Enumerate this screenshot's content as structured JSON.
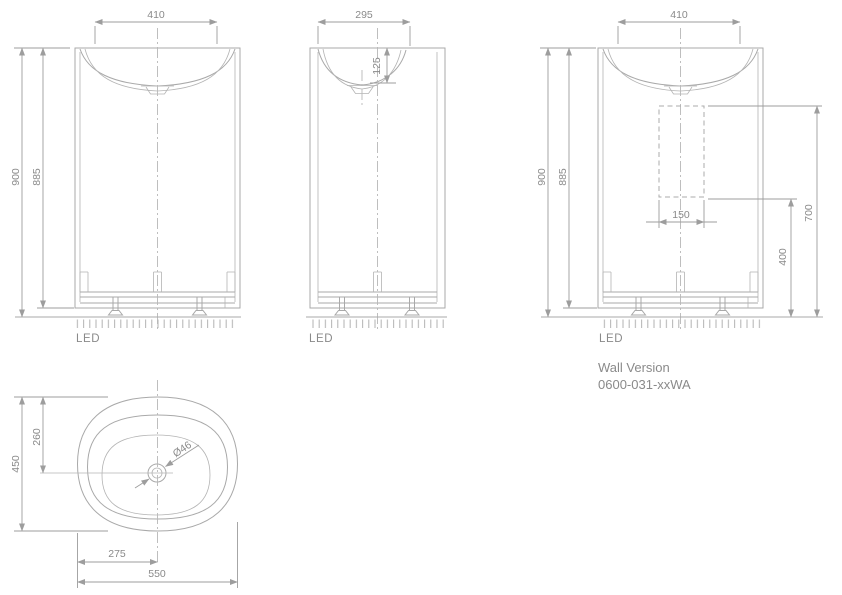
{
  "palette": {
    "line": "#a9a9a9",
    "dim_line": "#9d9d9d",
    "text": "#8a8a8a",
    "background": "#ffffff"
  },
  "front_view": {
    "width_top": "410",
    "height_overall": "900",
    "height_body": "885",
    "ground_label": "LED"
  },
  "side_view": {
    "width_top": "295",
    "bowl_depth": "125",
    "ground_label": "LED"
  },
  "wall_view": {
    "width_top": "410",
    "height_overall": "900",
    "height_body": "885",
    "cutout_width": "150",
    "cutout_bottom_height": "400",
    "cutout_top_height": "700",
    "ground_label": "LED",
    "caption_title": "Wall Version",
    "caption_code": "0600-031-xxWA"
  },
  "plan_view": {
    "depth_overall": "450",
    "drain_from_back": "260",
    "drain_diameter": "Ø46",
    "drain_from_left": "275",
    "width_overall": "550"
  }
}
